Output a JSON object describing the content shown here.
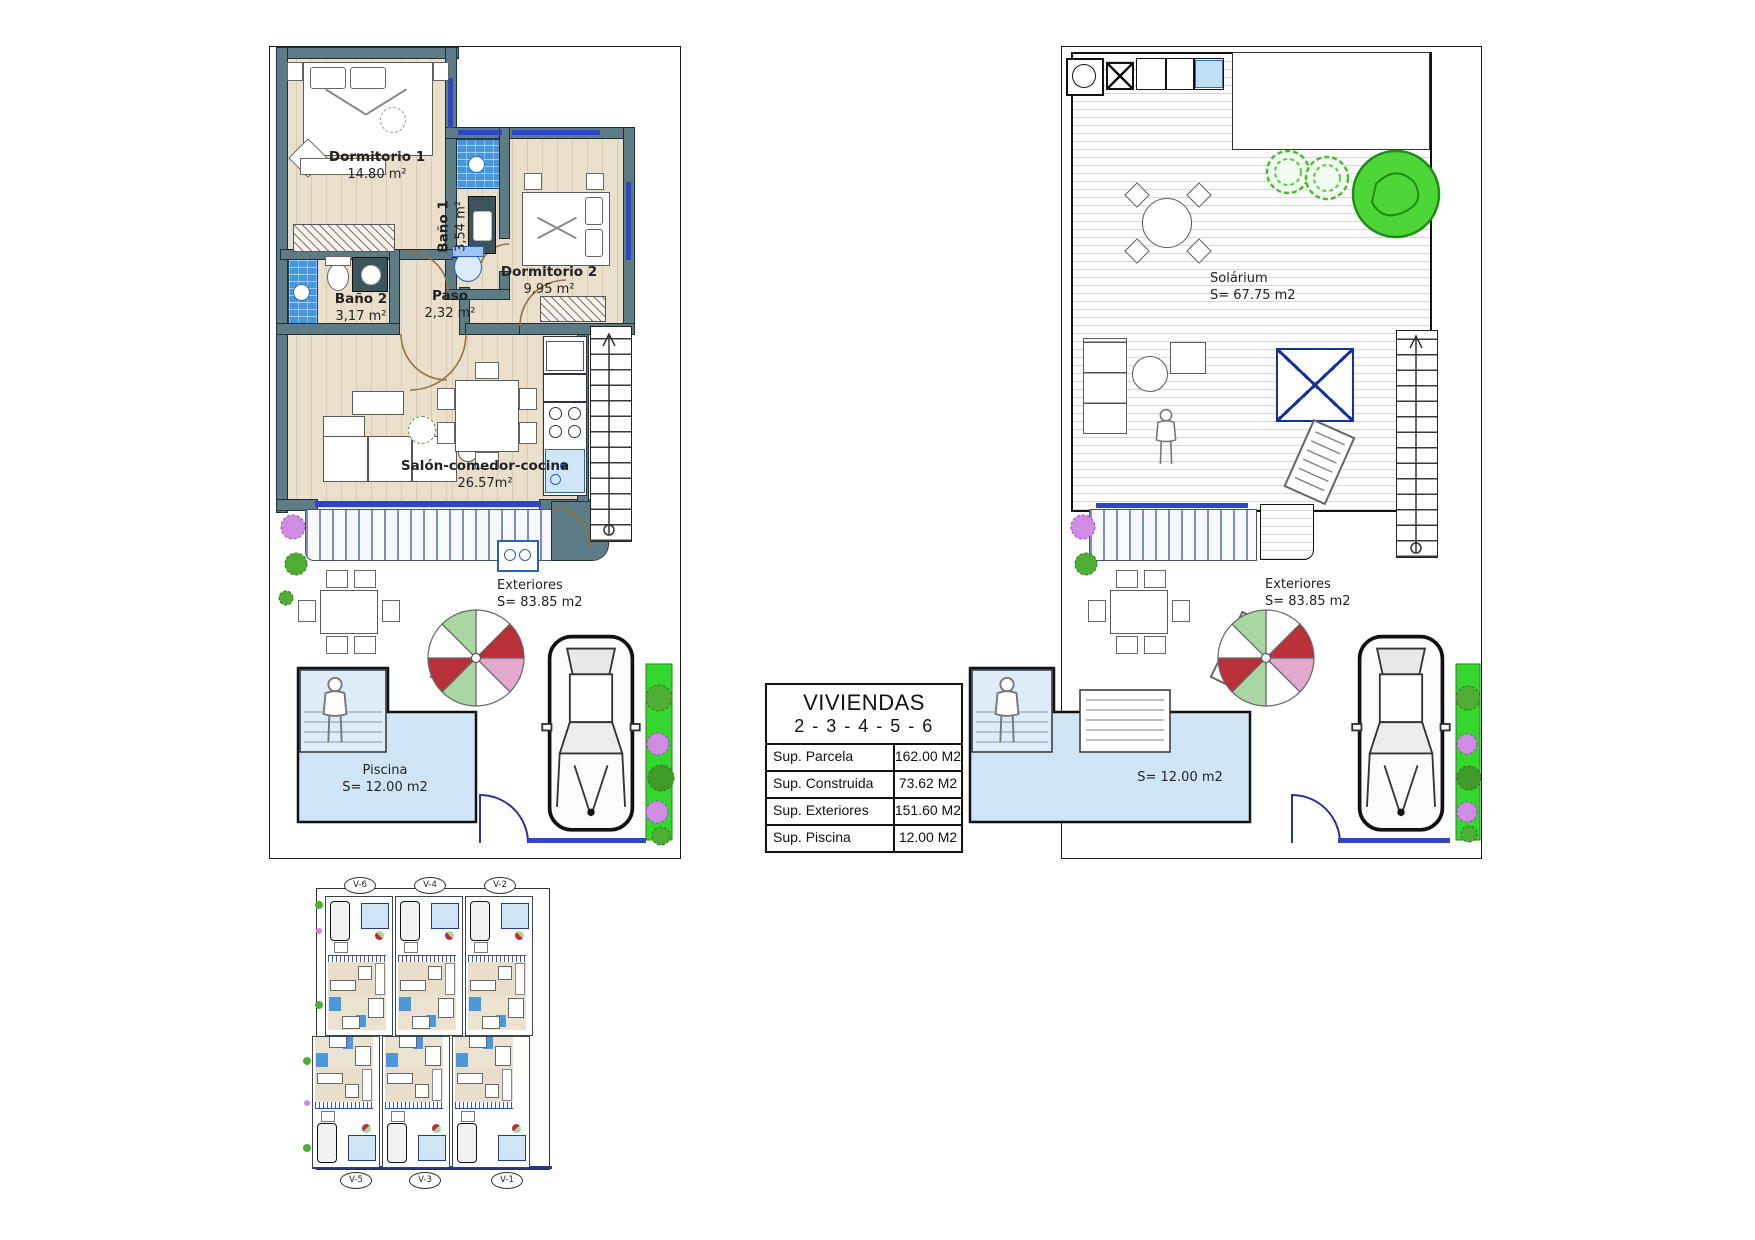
{
  "sheet": {
    "description": "Floor plan sheet"
  },
  "ground_floor": {
    "rooms": [
      {
        "name": "Dormitorio 1",
        "area": "14.80 m²"
      },
      {
        "name": "Baño 1",
        "area": "3,54 m²"
      },
      {
        "name": "Dormitorio 2",
        "area": "9,95 m²"
      },
      {
        "name": "Baño 2",
        "area": "3,17 m²"
      },
      {
        "name": "Paso",
        "area": "2,32 m²"
      },
      {
        "name": "Salón-comedor-cocina",
        "area": "26.57m²"
      }
    ],
    "exterior": {
      "name": "Exteriores",
      "area": "S= 83.85 m2"
    },
    "pool": {
      "name": "Piscina",
      "area": "S= 12.00 m2"
    }
  },
  "roof_floor": {
    "solarium": {
      "name": "Solárium",
      "area": "S= 67.75 m2"
    },
    "exterior": {
      "name": "Exteriores",
      "area": "S= 83.85 m2"
    },
    "pool": {
      "area": "S= 12.00 m2"
    }
  },
  "title_block": {
    "title": "VIVIENDAS",
    "subtitle": "2 - 3 - 4 - 5 - 6",
    "rows": [
      {
        "label": "Sup. Parcela",
        "value": "162.00 M2"
      },
      {
        "label": "Sup. Construida",
        "value": "73.62 M2"
      },
      {
        "label": "Sup. Exteriores",
        "value": "151.60 M2"
      },
      {
        "label": "Sup. Piscina",
        "value": "12.00 M2"
      }
    ]
  },
  "site_plan": {
    "units": [
      {
        "label": "V-6"
      },
      {
        "label": "V-4"
      },
      {
        "label": "V-2"
      },
      {
        "label": "V-5"
      },
      {
        "label": "V-3"
      },
      {
        "label": "V-1"
      }
    ]
  },
  "colors": {
    "wall": "#5c7c86",
    "floor": "#eadfcb",
    "bath_tile": "#4796db",
    "pool": "#cfe4f5",
    "window": "#2b46cc",
    "grass": "#35d62e"
  }
}
